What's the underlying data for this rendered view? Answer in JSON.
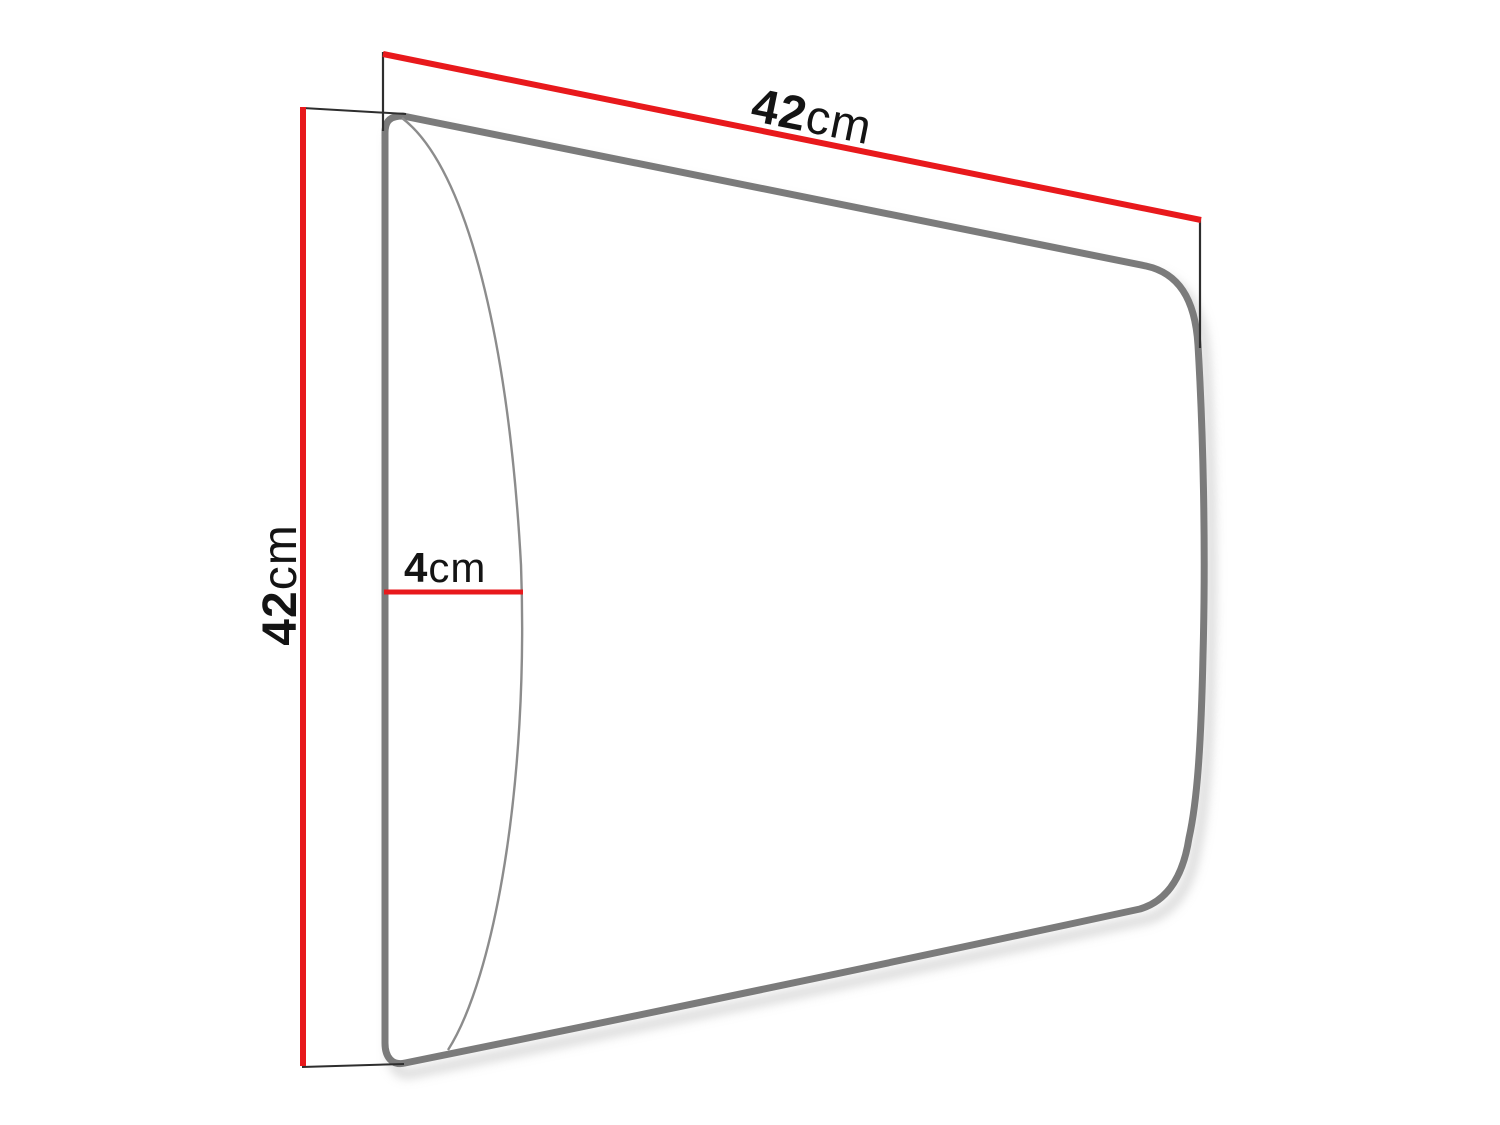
{
  "diagram": {
    "type": "product-dimension-diagram",
    "labels": {
      "width": {
        "value": "42",
        "unit": "cm"
      },
      "height": {
        "value": "42",
        "unit": "cm"
      },
      "depth": {
        "value": "4",
        "unit": "cm"
      }
    },
    "colors": {
      "dimension_line": "#e8191c",
      "panel_outline": "#7b7b7b",
      "panel_front_edge": "#8c8c8c",
      "extension_line": "#2e2e2e",
      "label_text": "#141414",
      "shadow": "#c6c6c6",
      "background": "#ffffff"
    }
  }
}
